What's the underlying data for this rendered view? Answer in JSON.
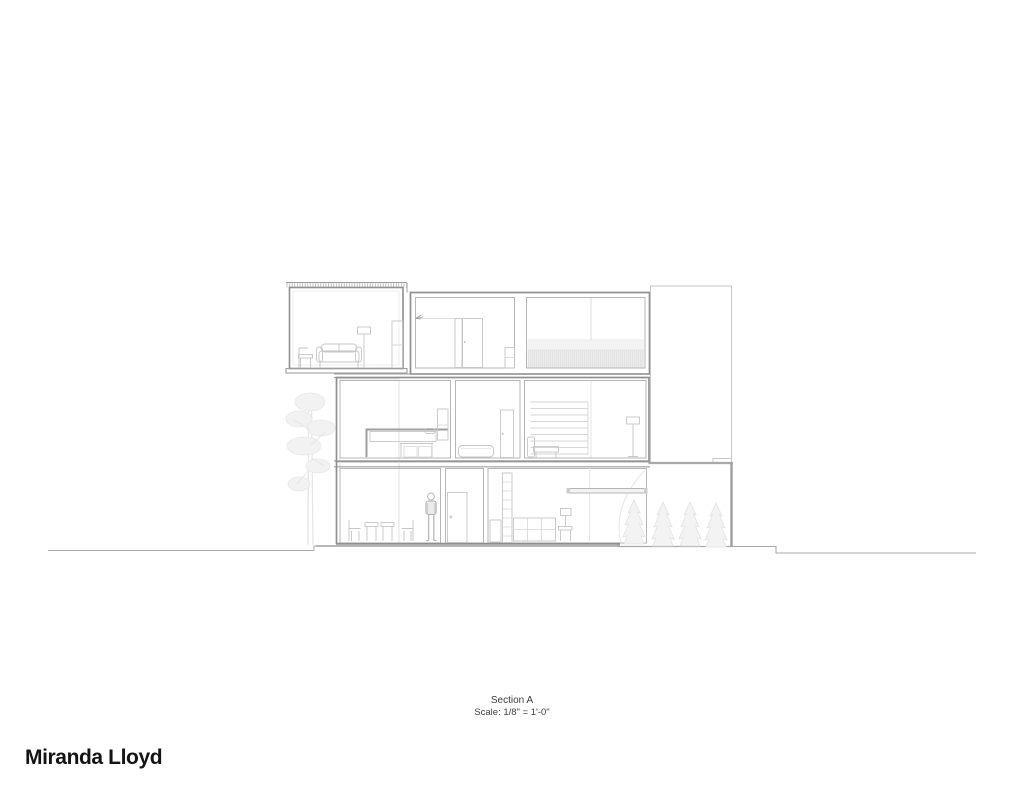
{
  "page": {
    "background": "#ffffff"
  },
  "title_block": {
    "title": "Section A",
    "scale": "Scale: 1/8\" = 1'-0\""
  },
  "author": {
    "name": "Miranda Lloyd"
  },
  "drawing": {
    "kind": "architectural-building-section",
    "colors": {
      "cut_wall": "#8f8f8f",
      "secondary_wall": "#b6b6b6",
      "furniture_line": "#c6c6c6",
      "vegetation": "#e4e4e4",
      "glazing_fill": "#f5f5f5",
      "ground_line": "#a9a9a9",
      "text": "#3d3d3d"
    },
    "elements": [
      "roof-hatch",
      "upper-lounge",
      "upper-closet-room",
      "upper-loft-room",
      "railing-band",
      "bedroom",
      "bathroom",
      "stair-room",
      "dining-room",
      "hallway-door",
      "living-room",
      "side-wing",
      "pine-tree",
      "conifer-trees",
      "person-figure",
      "ground-line"
    ]
  }
}
